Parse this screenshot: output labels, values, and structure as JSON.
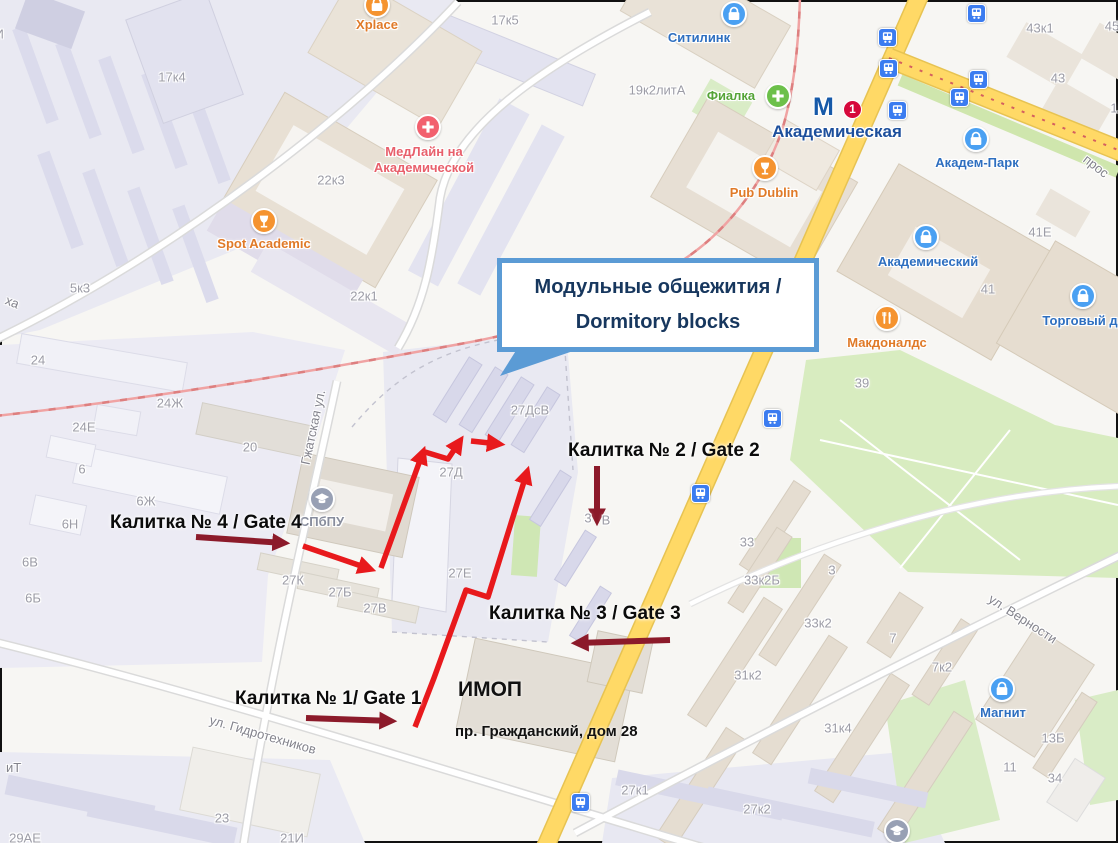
{
  "callout": {
    "line1": "Модульные общежития /",
    "line2": "Dormitory blocks"
  },
  "imop": {
    "name": "ИМОП",
    "address": "пр. Гражданский, дом 28"
  },
  "metro": {
    "logo": "М",
    "badge": "1",
    "name": "Академическая"
  },
  "gates": [
    {
      "id": "gate-4",
      "label": "Калитка № 4 / Gate 4",
      "x": 110,
      "y": 512
    },
    {
      "id": "gate-2",
      "label": "Калитка № 2 / Gate 2",
      "x": 568,
      "y": 440
    },
    {
      "id": "gate-3",
      "label": "Калитка № 3 / Gate 3",
      "x": 489,
      "y": 603
    },
    {
      "id": "gate-1",
      "label": "Калитка № 1/ Gate 1",
      "x": 235,
      "y": 688
    }
  ],
  "pois": [
    {
      "name": "Xplace",
      "icon": "bag",
      "c": "orange",
      "ix": 377,
      "iy": 5,
      "lx": 377,
      "ly": 17
    },
    {
      "name": "МедЛайн на Академической",
      "lines": [
        "МедЛайн на",
        "Академической"
      ],
      "icon": "cross",
      "c": "pink",
      "ix": 428,
      "iy": 127,
      "lx": 424,
      "ly": 144
    },
    {
      "name": "Spot Academic",
      "icon": "goblet",
      "c": "orange",
      "ix": 264,
      "iy": 221,
      "lx": 264,
      "ly": 236
    },
    {
      "name": "Ситилинк",
      "icon": "bag",
      "c": "blue",
      "ix": 734,
      "iy": 14,
      "lx": 699,
      "ly": 30
    },
    {
      "name": "Фиалка",
      "icon": "cross",
      "c": "green",
      "ix": 778,
      "iy": 96,
      "lx": 731,
      "ly": 88
    },
    {
      "name": "Pub Dublin",
      "icon": "goblet",
      "c": "orange",
      "ix": 765,
      "iy": 168,
      "lx": 764,
      "ly": 185
    },
    {
      "name": "Академ-Парк",
      "icon": "bag",
      "c": "blue",
      "ix": 976,
      "iy": 139,
      "lx": 977,
      "ly": 155
    },
    {
      "name": "Академический",
      "icon": "bag",
      "c": "blue",
      "ix": 926,
      "iy": 237,
      "lx": 928,
      "ly": 254
    },
    {
      "name": "Торговый д",
      "icon": "bag",
      "c": "blue",
      "ix": 1083,
      "iy": 296,
      "lx": 1080,
      "ly": 313
    },
    {
      "name": "Макдоналдс",
      "icon": "fork",
      "c": "orange",
      "ix": 887,
      "iy": 318,
      "lx": 887,
      "ly": 335
    },
    {
      "name": "Магнит",
      "icon": "bag",
      "c": "blue",
      "ix": 1002,
      "iy": 689,
      "lx": 1003,
      "ly": 705
    },
    {
      "name": "СПбПУ",
      "icon": "grad",
      "c": "gray",
      "ix": 322,
      "iy": 499,
      "lx": 322,
      "ly": 514
    },
    {
      "name": "",
      "icon": "grad",
      "c": "gray",
      "ix": 897,
      "iy": 831,
      "lx": 0,
      "ly": 0
    }
  ],
  "transit_stops": [
    [
      887,
      37
    ],
    [
      888,
      68
    ],
    [
      897,
      110
    ],
    [
      959,
      97
    ],
    [
      978,
      79
    ],
    [
      976,
      13
    ],
    [
      772,
      418
    ],
    [
      700,
      493
    ],
    [
      580,
      802
    ]
  ],
  "buildings": [
    {
      "t": "17И",
      "x": -8,
      "y": 34
    },
    {
      "t": "17к4",
      "x": 172,
      "y": 77
    },
    {
      "t": "17к5",
      "x": 505,
      "y": 20
    },
    {
      "t": "22к3",
      "x": 331,
      "y": 180
    },
    {
      "t": "22к1",
      "x": 364,
      "y": 296
    },
    {
      "t": "5к3",
      "x": 80,
      "y": 288
    },
    {
      "t": "24",
      "x": 38,
      "y": 360
    },
    {
      "t": "24Ж",
      "x": 170,
      "y": 403
    },
    {
      "t": "24Е",
      "x": 84,
      "y": 427
    },
    {
      "t": "6",
      "x": 82,
      "y": 469
    },
    {
      "t": "6Ж",
      "x": 146,
      "y": 501
    },
    {
      "t": "6Н",
      "x": 70,
      "y": 524
    },
    {
      "t": "6В",
      "x": 30,
      "y": 562
    },
    {
      "t": "6Б",
      "x": 33,
      "y": 598
    },
    {
      "t": "20",
      "x": 250,
      "y": 447
    },
    {
      "t": "27ДсВ",
      "x": 530,
      "y": 410
    },
    {
      "t": "27Д",
      "x": 451,
      "y": 472
    },
    {
      "t": "27Е",
      "x": 460,
      "y": 573
    },
    {
      "t": "27К",
      "x": 293,
      "y": 580
    },
    {
      "t": "27Б",
      "x": 340,
      "y": 592
    },
    {
      "t": "27В",
      "x": 375,
      "y": 608
    },
    {
      "t": "3",
      "x": 588,
      "y": 518
    },
    {
      "t": "В",
      "x": 606,
      "y": 520
    },
    {
      "t": "23",
      "x": 222,
      "y": 818
    },
    {
      "t": "21И",
      "x": 292,
      "y": 838
    },
    {
      "t": "29АЕ",
      "x": 25,
      "y": 838
    },
    {
      "t": "19к2литА",
      "x": 657,
      "y": 90
    },
    {
      "t": "43к1",
      "x": 1040,
      "y": 28
    },
    {
      "t": "43",
      "x": 1058,
      "y": 78
    },
    {
      "t": "45",
      "x": 1112,
      "y": 26
    },
    {
      "t": "41Е",
      "x": 1040,
      "y": 232
    },
    {
      "t": "41",
      "x": 988,
      "y": 289
    },
    {
      "t": "39",
      "x": 862,
      "y": 383
    },
    {
      "t": "33",
      "x": 747,
      "y": 542
    },
    {
      "t": "33к2Б",
      "x": 762,
      "y": 580
    },
    {
      "t": "33к2",
      "x": 818,
      "y": 623
    },
    {
      "t": "3",
      "x": 832,
      "y": 570
    },
    {
      "t": "7",
      "x": 893,
      "y": 638
    },
    {
      "t": "7к2",
      "x": 942,
      "y": 667
    },
    {
      "t": "31к2",
      "x": 748,
      "y": 675
    },
    {
      "t": "31к4",
      "x": 838,
      "y": 728
    },
    {
      "t": "13Б",
      "x": 1053,
      "y": 738
    },
    {
      "t": "11",
      "x": 1010,
      "y": 767
    },
    {
      "t": "34",
      "x": 1055,
      "y": 778
    },
    {
      "t": "27к2",
      "x": 757,
      "y": 809
    },
    {
      "t": "27к1",
      "x": 635,
      "y": 790
    },
    {
      "t": "1",
      "x": 1114,
      "y": 108
    }
  ],
  "streets": [
    {
      "label": "Гжатская ул.",
      "x": 305,
      "y": 457,
      "angle": -78
    },
    {
      "label": "ул. Гидротехников",
      "x": 210,
      "y": 712,
      "angle": 16
    },
    {
      "label": "ул. Верности",
      "x": 990,
      "y": 590,
      "angle": 33
    },
    {
      "label": "прос",
      "x": 1085,
      "y": 150,
      "angle": 38
    },
    {
      "label": "ха",
      "x": 6,
      "y": 292,
      "angle": 22
    },
    {
      "label": "иТ",
      "x": 6,
      "y": 760,
      "angle": 0
    }
  ],
  "colors": {
    "blue_bg": "#4aa0f2",
    "blue_fg": "#2e6fc0",
    "orange_bg": "#f5932f",
    "orange_fg": "#e07a28",
    "green_bg": "#6cc04a",
    "green_fg": "#55a437",
    "pink_bg": "#f2606e",
    "pink_fg": "#e85f6b",
    "gray_bg": "#98a0b4",
    "gray_fg": "#878c9c",
    "route_red": "#e8191c",
    "gate_arrow_red": "#8c1a2a",
    "callout_border": "#5b9bd5",
    "callout_text": "#17375e",
    "metro_blue": "#1659a8",
    "metro_line_badge": "#d6083b",
    "road_yellow": "#ffd966",
    "railway_pink": "#f0a3a3"
  }
}
